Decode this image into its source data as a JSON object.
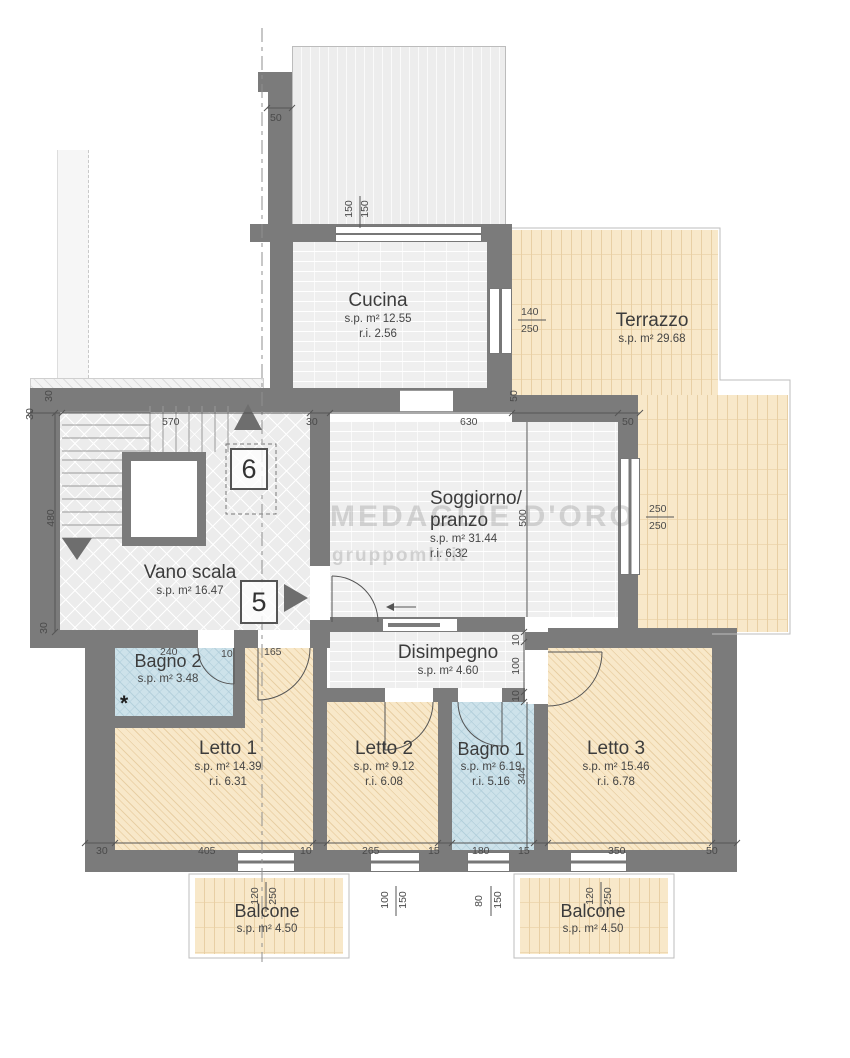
{
  "rooms": {
    "cucina": {
      "name": "Cucina",
      "sp": "s.p. m² 12.55",
      "ri": "r.i. 2.56"
    },
    "terrazzo": {
      "name": "Terrazzo",
      "sp": "s.p. m² 29.68"
    },
    "soggiorno": {
      "name_line1": "Soggiorno/",
      "name_line2": "pranzo",
      "sp": "s.p. m² 31.44",
      "ri": "r.i. 6.32"
    },
    "vano_scala": {
      "name": "Vano scala",
      "sp": "s.p. m² 16.47"
    },
    "disimpegno": {
      "name": "Disimpegno",
      "sp": "s.p. m² 4.60"
    },
    "bagno2": {
      "name": "Bagno 2",
      "sp": "s.p. m² 3.48",
      "note": "*"
    },
    "letto1": {
      "name": "Letto 1",
      "sp": "s.p. m² 14.39",
      "ri": "r.i. 6.31"
    },
    "letto2": {
      "name": "Letto 2",
      "sp": "s.p. m² 9.12",
      "ri": "r.i. 6.08"
    },
    "bagno1": {
      "name": "Bagno 1",
      "sp": "s.p. m² 6.19",
      "ri": "r.i. 5.16"
    },
    "letto3": {
      "name": "Letto 3",
      "sp": "s.p. m² 15.46",
      "ri": "r.i. 6.78"
    },
    "balcone_left": {
      "name": "Balcone",
      "sp": "s.p. m² 4.50"
    },
    "balcone_right": {
      "name": "Balcone",
      "sp": "s.p. m² 4.50"
    }
  },
  "markers": {
    "floor_6": "6",
    "floor_5": "5"
  },
  "watermark": {
    "line1": "MEDAGLIE D'ORO",
    "line2": "gruppomlr.it"
  },
  "dims": {
    "roof_offset": "50",
    "top_window_w": "150",
    "top_window_h": "150",
    "corner_wall_a": "30",
    "corner_wall_b": "30",
    "scala_width": "570",
    "scala_wall_right": "30",
    "soggiorno_width": "630",
    "right_wall": "50",
    "cucina_terrazzo_wall": "50",
    "cucina_window_w": "140",
    "cucina_window_h": "250",
    "soggiorno_window_w": "250",
    "soggiorno_window_h": "250",
    "soggiorno_depth": "500",
    "scala_depth": "480",
    "scala_wall_bottom": "30",
    "bagno2_width": "240",
    "bagno2_wall": "10",
    "bagno2_door": "165",
    "disimpegno_wall_top": "10",
    "disimpegno_depth": "100",
    "disimpegno_wall_bottom": "10",
    "bagno1_depth": "344",
    "bottom_wall_left": "30",
    "letto1_width": "405",
    "letto1_wall": "10",
    "letto2_width": "265",
    "letto2_wall": "15",
    "bagno1_width": "180",
    "bagno1_wall": "15",
    "letto3_width": "350",
    "letto3_wall": "50",
    "balcone_left_w": "120",
    "balcone_left_h": "250",
    "letto2_window_w": "100",
    "letto2_window_h": "150",
    "bagno1_window_w": "80",
    "bagno1_window_h": "150",
    "balcone_right_w": "120",
    "balcone_right_h": "250"
  },
  "colors": {
    "wall": "#7b7b7b",
    "tile_tan": "#f8e8c9",
    "tile_blue": "#cde2ea",
    "room_gray": "#efefef"
  }
}
